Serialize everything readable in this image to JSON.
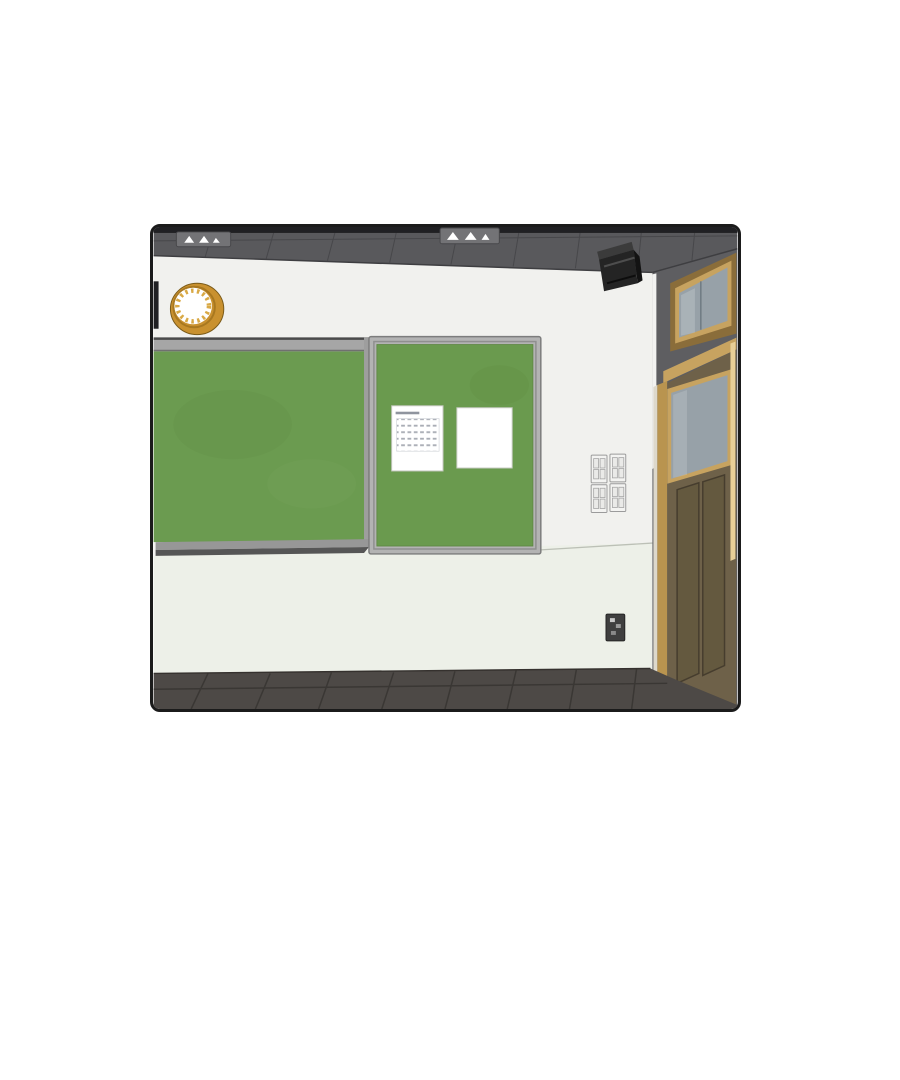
{
  "scene": {
    "description": "3D rendered classroom interior panel: front wall with green chalkboard and green bulletin board holding a calendar sheet and a blank sheet, wall clock, corner speaker, light switch bank, wall outlet, wooden door with transom window at right, dark tiled ceiling and floor",
    "objects": [
      "ceiling",
      "ceiling-light-fixtures",
      "wall-clock",
      "chalkboard",
      "chalk-tray",
      "bulletin-board",
      "calendar-paper",
      "blank-paper",
      "speaker",
      "light-switch-bank",
      "wall-outlet",
      "door",
      "door-window",
      "transom-window",
      "floor"
    ]
  },
  "colors": {
    "page_bg": "#ffffff",
    "panel_border": "#1b1b1b",
    "black_trim": "#202023",
    "ceiling": "#59595c",
    "ceiling_grid": "#47474a",
    "fixture_gray": "#737376",
    "wall_upper": "#f1f1ee",
    "wall_lower": "#edf0e8",
    "wall_right": "#5e5e61",
    "chalk_green": "#6b9b50",
    "board_green": "#6a9a4e",
    "frame_silver": "#b3b3b3",
    "rail_gray": "#a6a6a6",
    "tray_gray": "#979797",
    "tray_shadow": "#565656",
    "clock_gold": "#c9912f",
    "clock_tick": "#d9a945",
    "paper_white": "#ffffff",
    "speaker_black": "#242424",
    "door_wood": "#6e6149",
    "door_panel": "#64593f",
    "frame_tan": "#c7a360",
    "frame_tan_bright": "#e8cf97",
    "jamb_light": "#ddd8cb",
    "glass": "#97a1a8",
    "floor": "#4d4946",
    "floor_grid": "#3a3734",
    "switch_plate": "#f3f3f1",
    "switch_border": "#9b9b9b",
    "outlet": "#3f3f3f"
  }
}
